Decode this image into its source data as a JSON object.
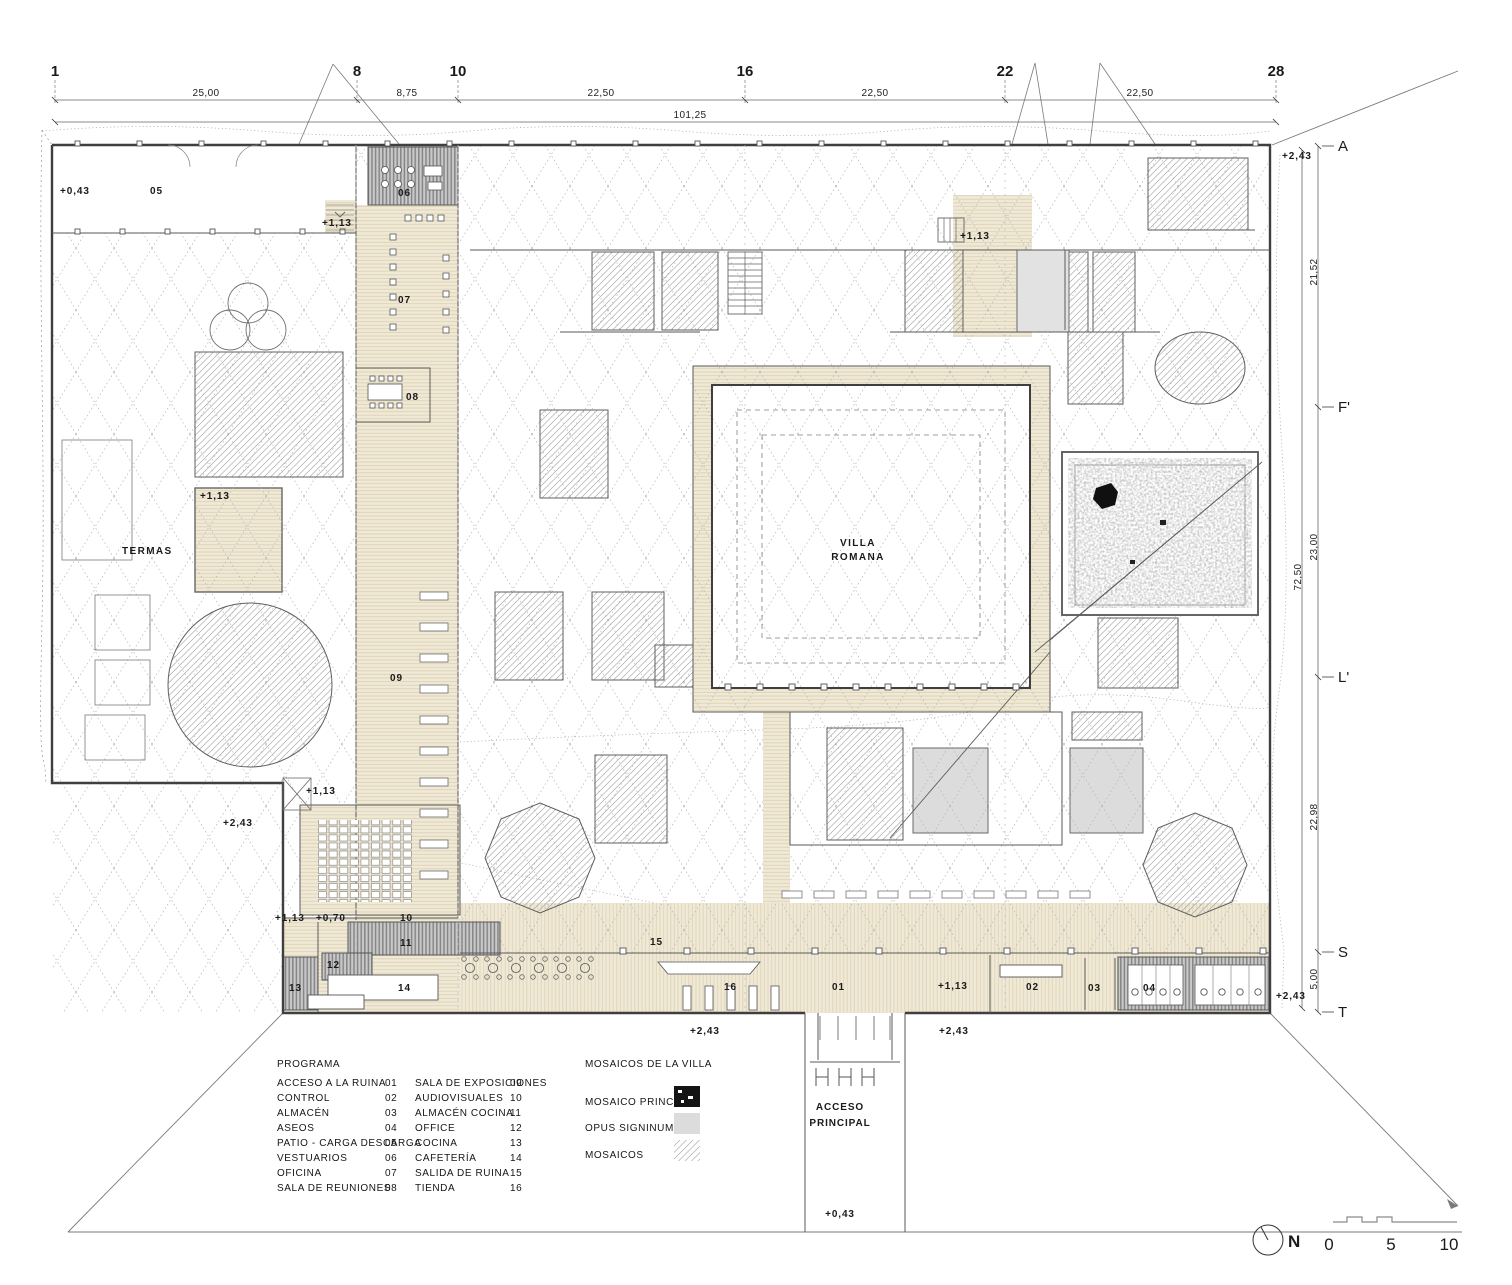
{
  "grid": {
    "c1": "1",
    "c8": "8",
    "c10": "10",
    "c16": "16",
    "c22": "22",
    "c28": "28",
    "d1": "25,00",
    "d2": "8,75",
    "d3": "22,50",
    "d4": "22,50",
    "d5": "22,50",
    "total": "101,25",
    "rA": "A",
    "rF": "F'",
    "rL": "L'",
    "rS": "S",
    "rT": "T",
    "v1": "21,52",
    "v2": "23,00",
    "v3": "22,98",
    "v4": "5,00",
    "vtotal": "72,50"
  },
  "levels": {
    "p043": "+0,43",
    "p070": "+0,70",
    "p113": "+1,13",
    "p243": "+2,43"
  },
  "rooms": {
    "n01": "01",
    "n02": "02",
    "n03": "03",
    "n04": "04",
    "n05": "05",
    "n06": "06",
    "n07": "07",
    "n08": "08",
    "n09": "09",
    "n10": "10",
    "n11": "11",
    "n12": "12",
    "n13": "13",
    "n14": "14",
    "n15": "15",
    "n16": "16"
  },
  "plan": {
    "termas": "TERMAS",
    "villa1": "VILLA",
    "villa2": "ROMANA",
    "acceso1": "ACCESO",
    "acceso2": "PRINCIPAL"
  },
  "program": {
    "title": "PROGRAMA",
    "col1": [
      {
        "label": "ACCESO A LA RUINA",
        "num": "01"
      },
      {
        "label": "CONTROL",
        "num": "02"
      },
      {
        "label": "ALMACÉN",
        "num": "03"
      },
      {
        "label": "ASEOS",
        "num": "04"
      },
      {
        "label": "PATIO - CARGA DESCARGA",
        "num": "05"
      },
      {
        "label": "VESTUARIOS",
        "num": "06"
      },
      {
        "label": "OFICINA",
        "num": "07"
      },
      {
        "label": "SALA DE REUNIONES",
        "num": "08"
      }
    ],
    "col2": [
      {
        "label": "SALA DE EXPOSICIONES",
        "num": "09"
      },
      {
        "label": "AUDIOVISUALES",
        "num": "10"
      },
      {
        "label": "ALMACÉN COCINA",
        "num": "11"
      },
      {
        "label": "OFFICE",
        "num": "12"
      },
      {
        "label": "COCINA",
        "num": "13"
      },
      {
        "label": "CAFETERÍA",
        "num": "14"
      },
      {
        "label": "SALIDA DE RUINA",
        "num": "15"
      },
      {
        "label": "TIENDA",
        "num": "16"
      }
    ]
  },
  "mosaics": {
    "title": "MOSAICOS DE LA VILLA",
    "principal": "MOSAICO PRINCIPAL",
    "opus": "OPUS SIGNINUM",
    "mosaicos": "MOSAICOS"
  },
  "scale": {
    "north": "N",
    "s0": "0",
    "s5": "5",
    "s10": "10"
  },
  "colors": {
    "beige": "#f0e9d6",
    "opus_gray": "#dcdcdc",
    "stripe_gray": "#c9c9c9",
    "wall": "#3f3f3f",
    "mosaic_black": "#101010"
  }
}
